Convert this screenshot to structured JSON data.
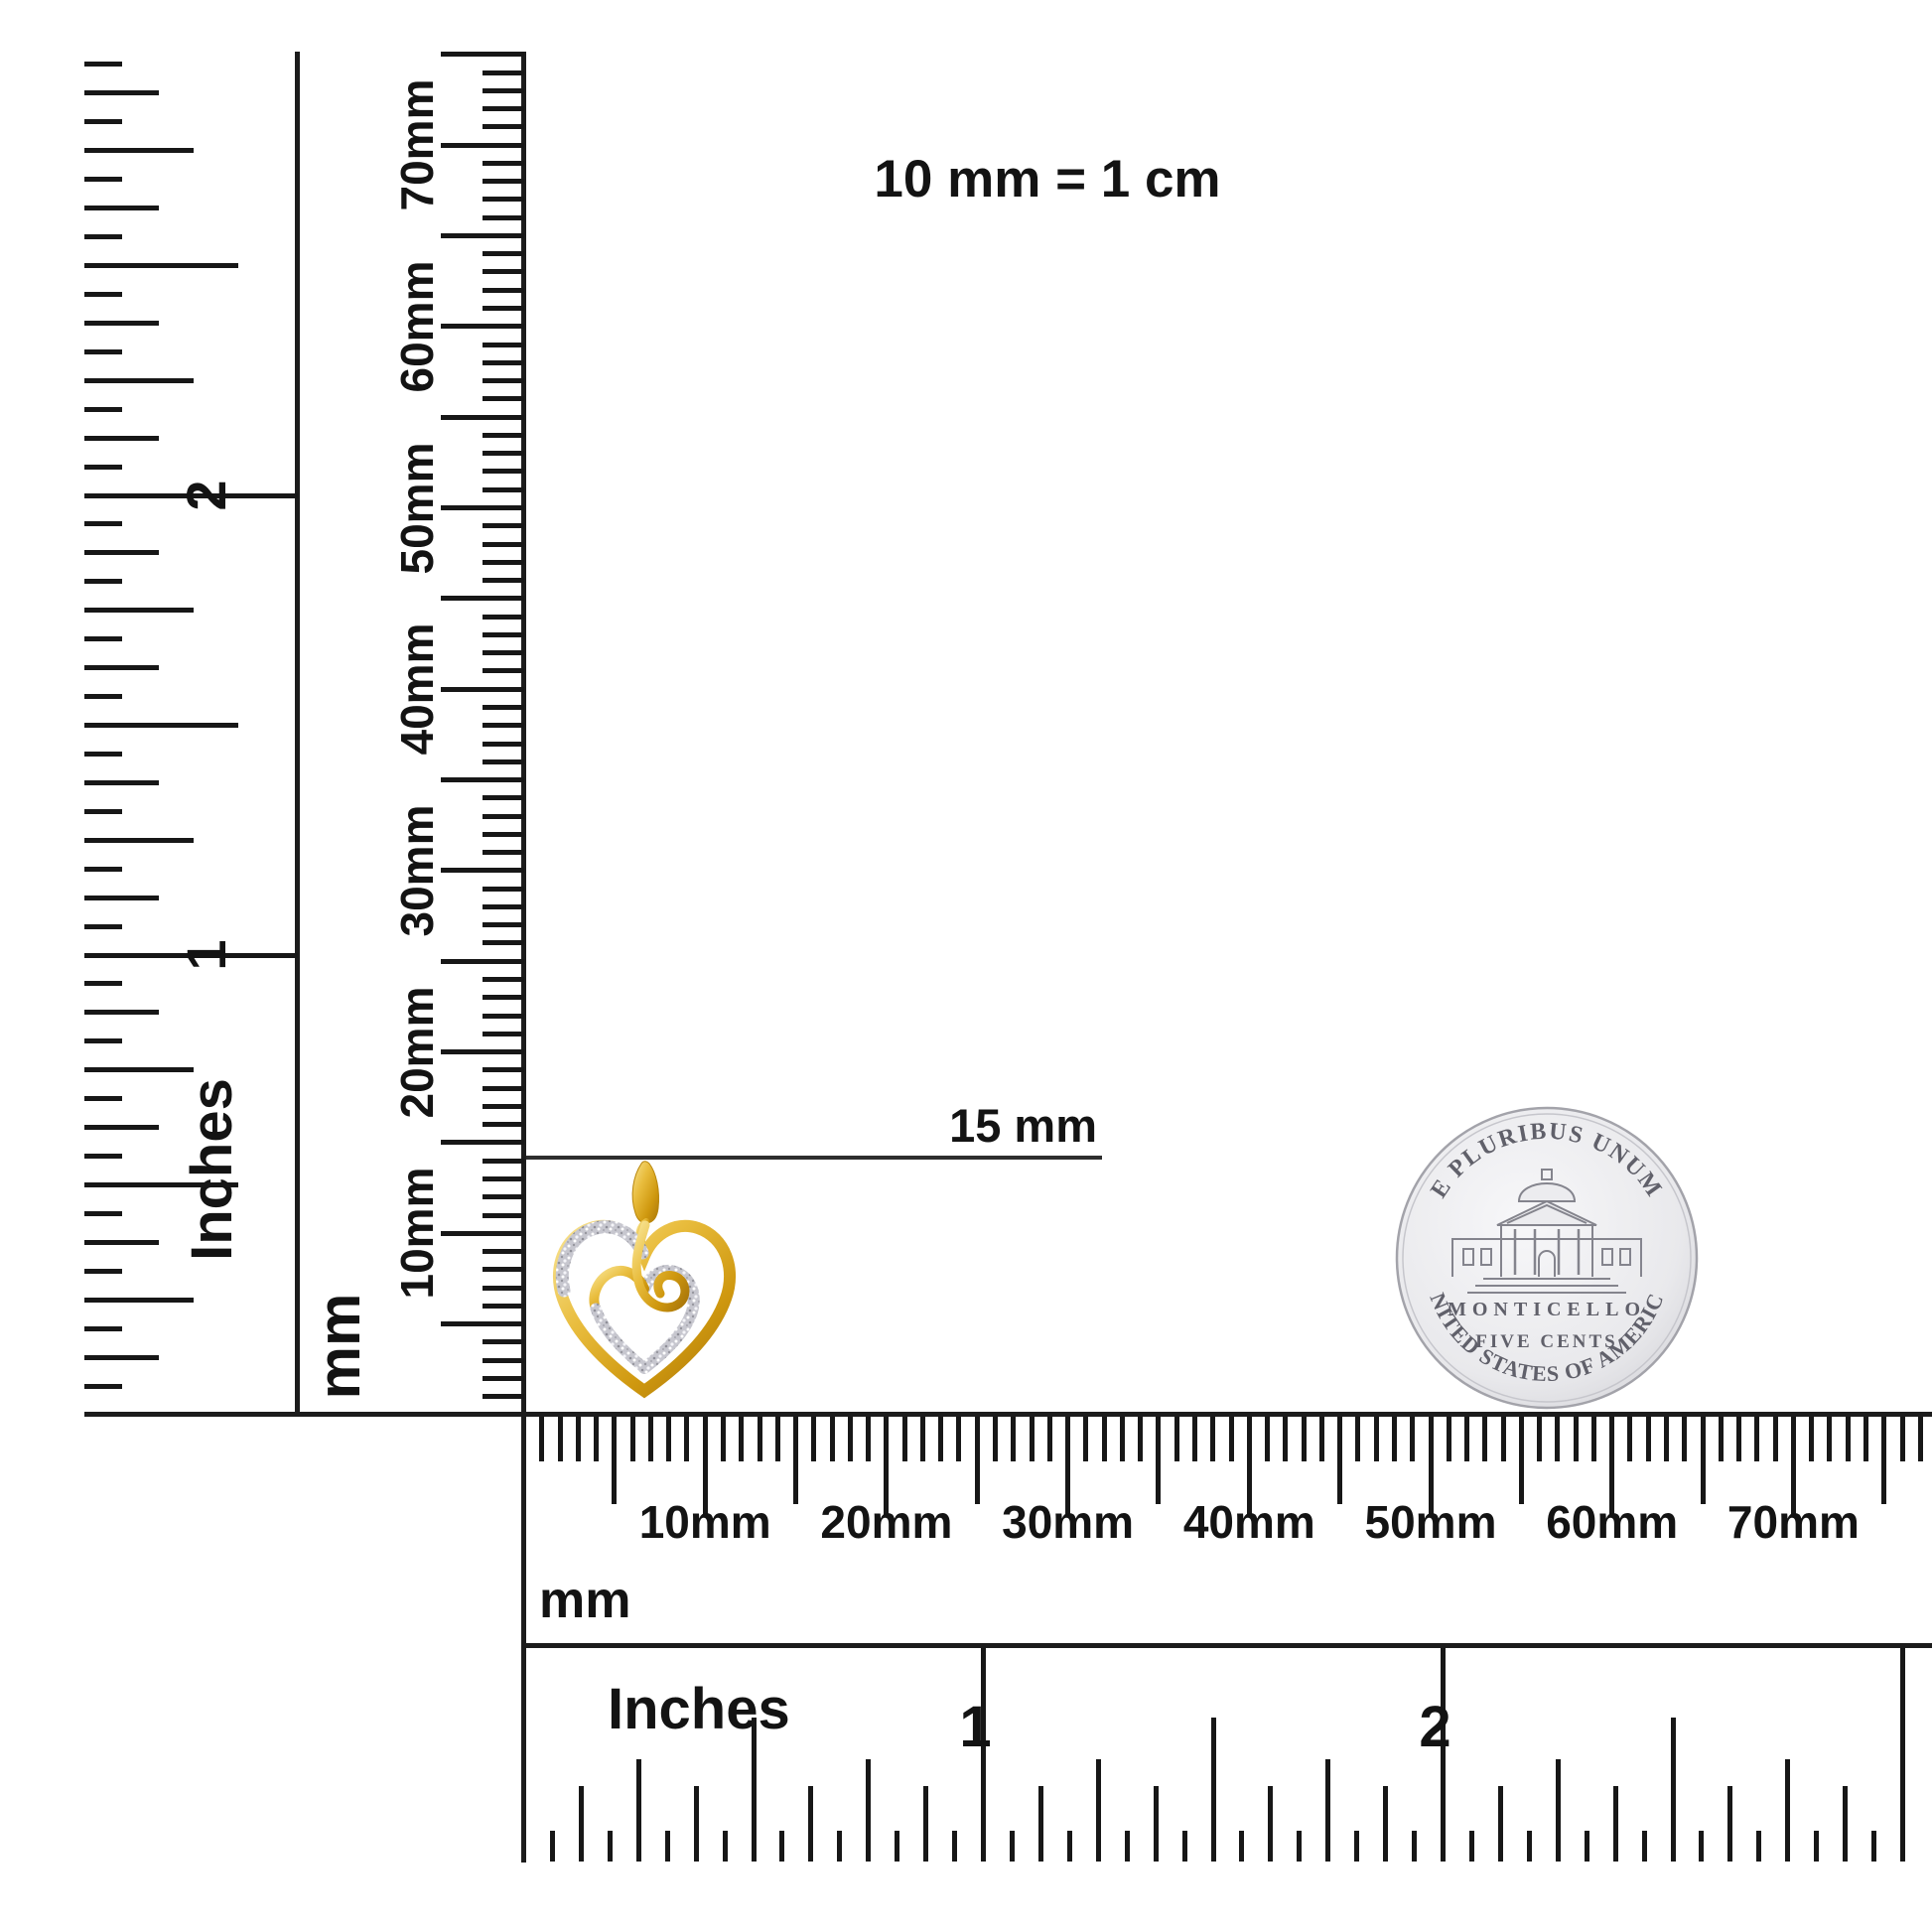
{
  "title": {
    "scale_note": "10 mm = 1 cm"
  },
  "callout": {
    "label": "15 mm"
  },
  "pendant": {
    "name": "yellow gold open heart pendant with swirl and glitter pave accents"
  },
  "coin": {
    "name": "US nickel reverse (Monticello)",
    "top_legend": "E PLURIBUS UNUM",
    "building_label": "MONTICELLO",
    "denomination": "FIVE   CENTS",
    "bottom_legend": "UNITED STATES OF AMERICA"
  },
  "rulers": {
    "left_inches": {
      "unit": "Inches",
      "numerals": [
        "1",
        "2"
      ]
    },
    "left_mm": {
      "unit": "mm",
      "labels": [
        "10mm",
        "20mm",
        "30mm",
        "40mm",
        "50mm",
        "60mm",
        "70mm"
      ]
    },
    "bottom_mm": {
      "unit": "mm",
      "labels": [
        "10mm",
        "20mm",
        "30mm",
        "40mm",
        "50mm",
        "60mm",
        "70mm"
      ]
    },
    "bottom_inches": {
      "unit": "Inches",
      "numerals": [
        "1",
        "2"
      ]
    }
  },
  "colors": {
    "ink": "#171717",
    "gold": "#d9a81f",
    "gold_light": "#f6dc82",
    "gold_dark": "#a8750a",
    "glitter": "#c7c7cf",
    "coin_silver": "#e9e9ec",
    "coin_text": "#60606a"
  }
}
